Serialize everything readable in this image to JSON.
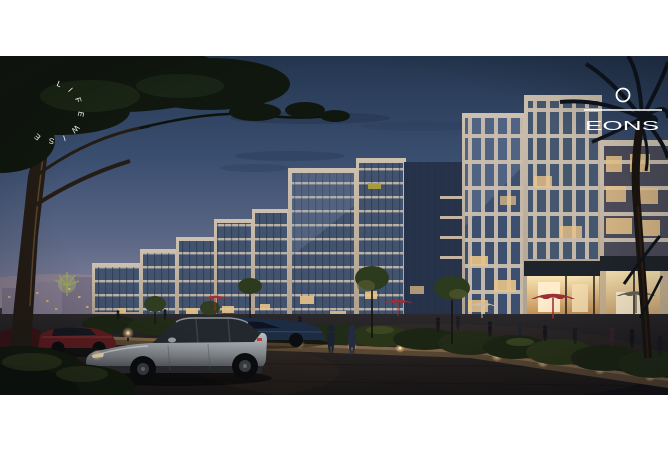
{
  "artwork": {
    "kind": "architectural dusk render of mixed-use residential complex",
    "arc_watermark": {
      "text": "LIFEWISE",
      "color": "#ffffff"
    },
    "logo": {
      "wordmark": "EONS",
      "symbol": "ring-over-rule",
      "color": "#ffffff"
    }
  },
  "palette": {
    "page_background": "#ffffff",
    "sky_top": "#24364f",
    "sky_horizon": "#ac9fa6",
    "facade_cream": "#c6b9a8",
    "glass_blue": "#42536f",
    "warm_light": "#e8c38a",
    "storefront_glow": "#f4ddae",
    "umbrella_red": "#9c3036",
    "hedge_green": "#1c2514",
    "road_dark": "#141316",
    "car_silver": "#9aa0a4",
    "car_red": "#5f1d20",
    "car_blue": "#1c2c42"
  }
}
